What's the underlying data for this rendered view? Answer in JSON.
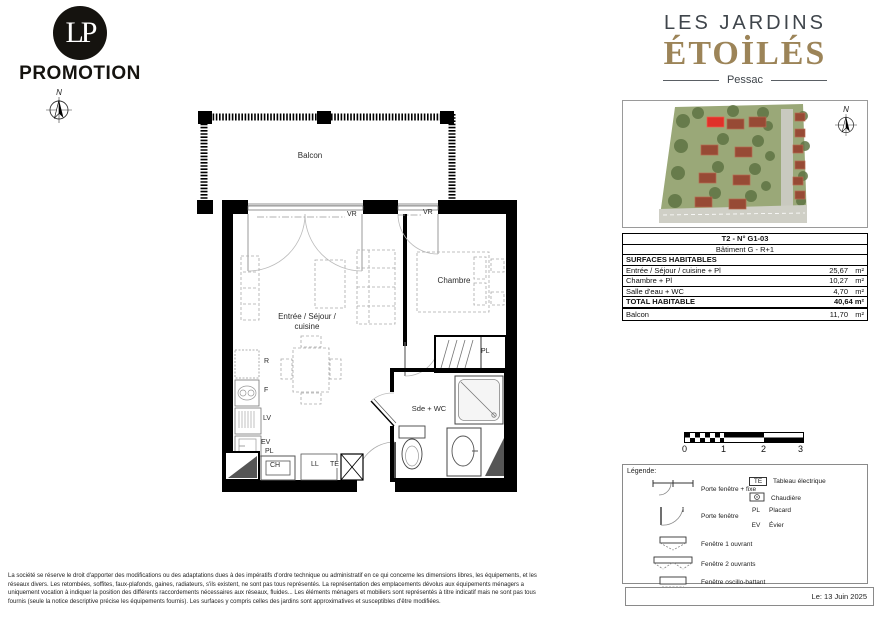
{
  "branding": {
    "logo_monogram": "LP",
    "logo_text": "PROMOTION",
    "project_name_line1": "LES JARDINS",
    "project_name_line2": "ÉTOİLÉS",
    "city": "Pessac"
  },
  "compass": {
    "north": "N"
  },
  "plan_labels": {
    "balcony": "Balcon",
    "living_line1": "Entrée / Séjour /",
    "living_line2": "cuisine",
    "bedroom": "Chambre",
    "bathroom": "Sde + WC",
    "shutter": "VR",
    "closet": "PL",
    "fridge": "R",
    "oven": "F",
    "dishwasher": "LV",
    "sink": "EV",
    "boiler": "CH",
    "washer": "LL",
    "electrical": "TE"
  },
  "surface_table": {
    "unit_title": "T2 - N° G1-03",
    "building": "Bâtiment G - R+1",
    "section_header": "SURFACES HABITABLES",
    "rows": [
      {
        "label": "Entrée / Séjour / cuisine + Pl",
        "value": "25,67",
        "unit": "m²"
      },
      {
        "label": "Chambre + Pl",
        "value": "10,27",
        "unit": "m²"
      },
      {
        "label": "Salle d'eau + WC",
        "value": "4,70",
        "unit": "m²"
      }
    ],
    "total_label": "TOTAL HABITABLE",
    "total_value": "40,64 m²",
    "balcony_label": "Balcon",
    "balcony_value": "11,70",
    "balcony_unit": "m²"
  },
  "scale_bar": {
    "ticks": [
      "0",
      "1",
      "2",
      "3"
    ]
  },
  "legend": {
    "title": "Légende:",
    "openings": [
      "Porte fenêtre + fixe",
      "Porte fenêtre",
      "Fenêtre 1 ouvrant",
      "Fenêtre 2 ouvrants",
      "Fenêtre oscillo-battant"
    ],
    "abbreviations": [
      {
        "symbol": "TE",
        "label": "Tableau électrique"
      },
      {
        "symbol": "",
        "label": "Chaudière"
      },
      {
        "symbol": "PL",
        "label": "Placard"
      },
      {
        "symbol": "EV",
        "label": "Évier"
      }
    ]
  },
  "footer": {
    "disclaimer": "La société se réserve le droit d'apporter des modifications ou des adaptations dues à des impératifs d'ordre technique ou administratif en ce qui concerne les dimensions libres, les équipements, et les réseaux divers. Les retombées, soffites, faux-plafonds, gaines, radiateurs, s'ils existent, ne sont pas tous représentés. La représentation des emplacements dévolus aux équipements ménagers a uniquement vocation à indiquer la position des différents raccordements nécessaires aux réseaux, fluides... Les éléments ménagers et mobiliers sont représentés à titre indicatif mais ne sont pas tous fournis (seule la notice descriptive précise les équipements fournis). Les surfaces y compris celles des jardins sont approximatives et susceptibles d'être modifiées.",
    "date": "Le: 13 Juin 2025"
  },
  "colors": {
    "accent_gold": "#9c8458",
    "dark_text": "#3f454b",
    "wall_black": "#000000",
    "roof_red": "#974a35",
    "highlight_red": "#e0312a"
  }
}
